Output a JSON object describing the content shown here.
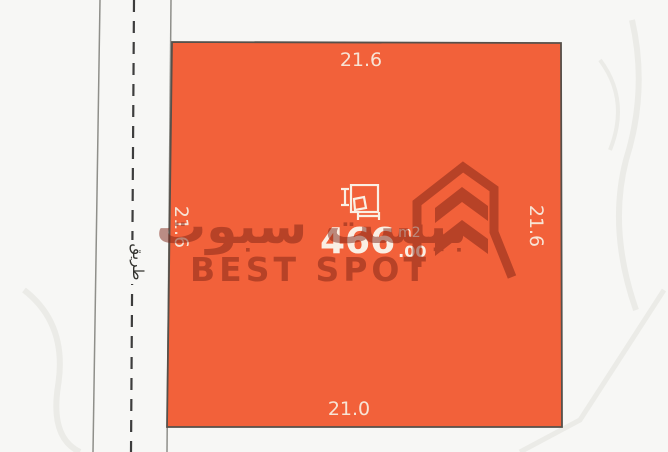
{
  "scene": {
    "description": "land plot cadastral map",
    "background_color": "#F7F7F5"
  },
  "road": {
    "label": "طريق"
  },
  "plot": {
    "fill_color": "#F2613A",
    "border_color": "#56504A",
    "area": {
      "value": "466",
      "decimal": ".00",
      "unit": "m2"
    },
    "dimensions": {
      "top": "21.6",
      "right": "21.6",
      "bottom": "21.0",
      "left": "21.6"
    }
  },
  "watermark": {
    "arabic_text": "بيست سبوت",
    "latin_text": "BEST SPOT",
    "color": "#7E2415",
    "logo_icon": "chevron-logo"
  }
}
